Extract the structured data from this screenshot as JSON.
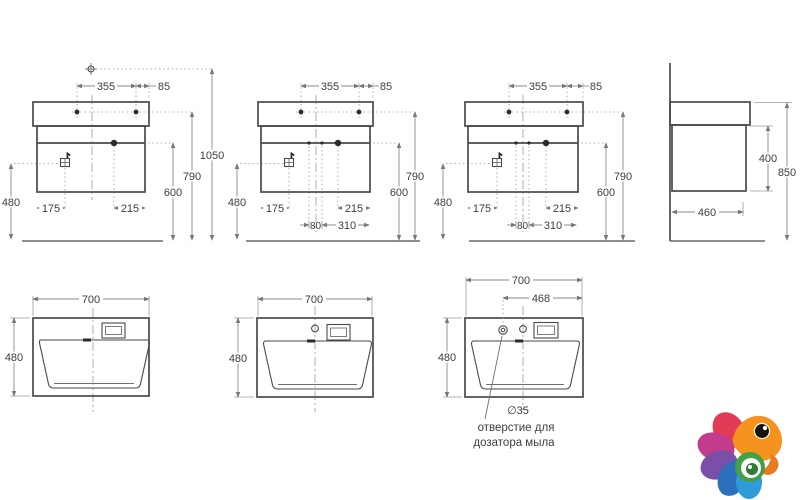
{
  "colors": {
    "object_line": "#4a4a4a",
    "dim_line": "#8a8a8a",
    "text": "#3d3d3d",
    "background": "#ffffff"
  },
  "fv1": {
    "d355": "355",
    "d85": "85",
    "d1050": "1050",
    "d790": "790",
    "d600": "600",
    "d480": "480",
    "d175": "175",
    "d215": "215"
  },
  "fv2": {
    "d355": "355",
    "d85": "85",
    "d790": "790",
    "d600": "600",
    "d480": "480",
    "d175": "175",
    "d215": "215",
    "d80": "80",
    "d310": "310"
  },
  "fv3": {
    "d355": "355",
    "d85": "85",
    "d790": "790",
    "d600": "600",
    "d480": "480",
    "d175": "175",
    "d215": "215",
    "d80": "80",
    "d310": "310"
  },
  "sv": {
    "d400": "400",
    "d850": "850",
    "d460": "460"
  },
  "tv1": {
    "d700": "700",
    "d480": "480"
  },
  "tv2": {
    "d700": "700",
    "d480": "480"
  },
  "tv3": {
    "d700": "700",
    "d468": "468",
    "d480": "480",
    "dia": "∅35",
    "note1": "отверстие для",
    "note2": "дозатора мыла"
  }
}
